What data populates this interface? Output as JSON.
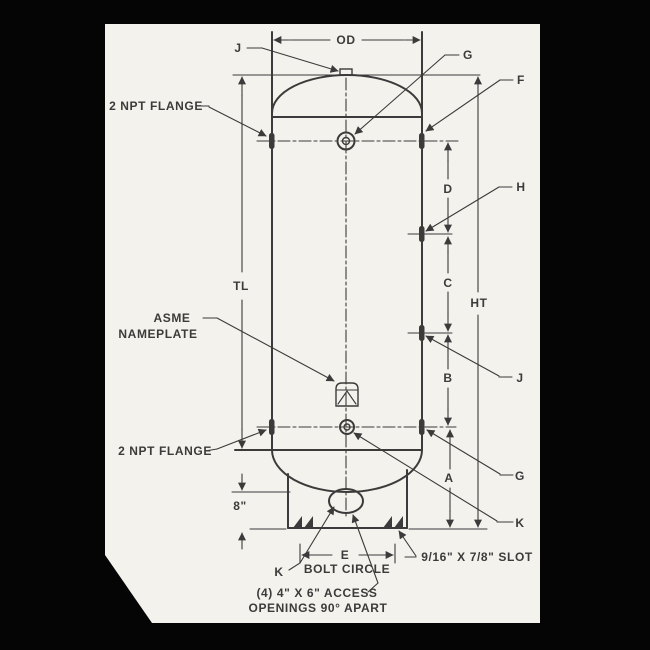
{
  "diagram": {
    "type": "technical-drawing",
    "subject": "vertical tank dimension diagram",
    "colors": {
      "background": "#050505",
      "paper": "#f4f2ec",
      "ink": "#3b3b3b"
    },
    "labels": {
      "od": "OD",
      "j_top": "J",
      "g_top": "G",
      "f": "F",
      "npt_flange_top": "2 NPT FLANGE",
      "h": "H",
      "d": "D",
      "c": "C",
      "ht": "HT",
      "tl": "TL",
      "asme_line1": "ASME",
      "asme_line2": "NAMEPLATE",
      "b": "B",
      "j_right": "J",
      "npt_flange_bottom": "2 NPT FLANGE",
      "g_bottom": "G",
      "a": "A",
      "k_right": "K",
      "skirt_height": "8\"",
      "e": "E",
      "bolt_circle": "BOLT CIRCLE",
      "k_left": "K",
      "slot_note": "9/16\" X 7/8\" SLOT",
      "access_note_line1": "(4) 4\" X 6\" ACCESS",
      "access_note_line2": "OPENINGS 90° APART"
    }
  }
}
